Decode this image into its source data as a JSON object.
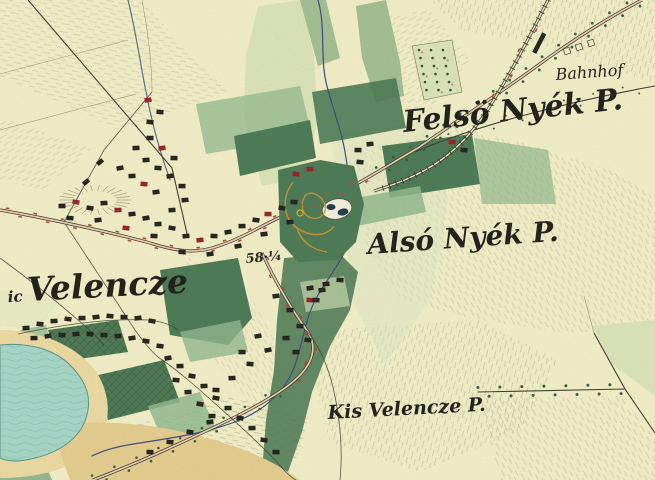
{
  "map": {
    "type": "historical-topographic-survey-map",
    "region": "Velencze / Nyék (Lake Velence area)",
    "labels": {
      "bahnhof": "Bahnhof",
      "felso_nyek": "Felsö Nyék P.",
      "also_nyek": "Alsó Nyék P.",
      "velencze_prefix": "ic",
      "velencze": "Velencze",
      "kis_velencze": "Kis Velencze P.",
      "elevation_marker": "58·¼"
    },
    "colors": {
      "paper": "#f0edc6",
      "field_light": "#d9e3b6",
      "field_olive": "#a4bd92",
      "field_mid": "#93b88e",
      "woods": "#4e7b57",
      "lake": "#a6d5c6",
      "lake_line": "#5d9484",
      "sand": "#ead9a2",
      "ochre": "#e3cc8e",
      "stream": "#3e4e85",
      "road_ink": "#423e31",
      "road_fill": "#e9cdb0",
      "road_red": "#b84a38",
      "building_ink": "#27261f",
      "building_red": "#96262c",
      "hachure": "#8b8566",
      "ink": "#23221c",
      "path_orange": "#d4952e"
    }
  }
}
